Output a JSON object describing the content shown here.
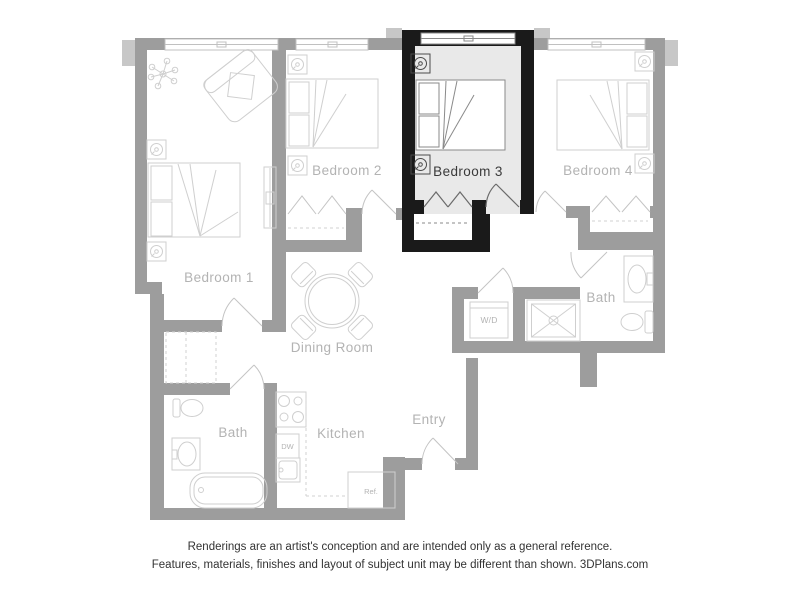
{
  "colors": {
    "background": "#ffffff",
    "wall": "#9d9d9d",
    "wall-light": "#c7c7c7",
    "wall-highlight": "#1a1a1a",
    "floor-highlight": "#e9e9e9",
    "furniture": "#cfcfcf",
    "furniture-highlight": "#8a8a8a",
    "fixture-highlight": "#4a4a4a",
    "door": "#c4c4c4",
    "door-highlight": "#6b6b6b",
    "dash": "#d2d2d2",
    "window-frame": "#c0c0c0",
    "window-frame-highlight": "#8a8a8a",
    "label": "#b3b3b3",
    "label-highlight": "#3a3a3a",
    "disclaimer": "#333333"
  },
  "floor_plan": {
    "highlighted_room": "Bedroom 3",
    "rooms": [
      {
        "id": "bedroom-1",
        "label": "Bedroom 1"
      },
      {
        "id": "bedroom-2",
        "label": "Bedroom 2"
      },
      {
        "id": "bedroom-3",
        "label": "Bedroom 3",
        "highlighted": true
      },
      {
        "id": "bedroom-4",
        "label": "Bedroom 4"
      },
      {
        "id": "bath-upper",
        "label": "Bath"
      },
      {
        "id": "dining-room",
        "label": "Dining Room"
      },
      {
        "id": "kitchen",
        "label": "Kitchen"
      },
      {
        "id": "entry",
        "label": "Entry"
      },
      {
        "id": "bath-lower",
        "label": "Bath"
      }
    ],
    "appliances": [
      {
        "id": "washer-dryer",
        "label": "W/D"
      },
      {
        "id": "dishwasher",
        "label": "DW"
      },
      {
        "id": "refrigerator",
        "label": "Ref."
      }
    ]
  },
  "disclaimer": {
    "line1": "Renderings are an artist's conception and are intended only as a general reference.",
    "line2": "Features, materials, finishes and layout of subject unit may be different than shown.",
    "brand": "3DPlans.com"
  }
}
